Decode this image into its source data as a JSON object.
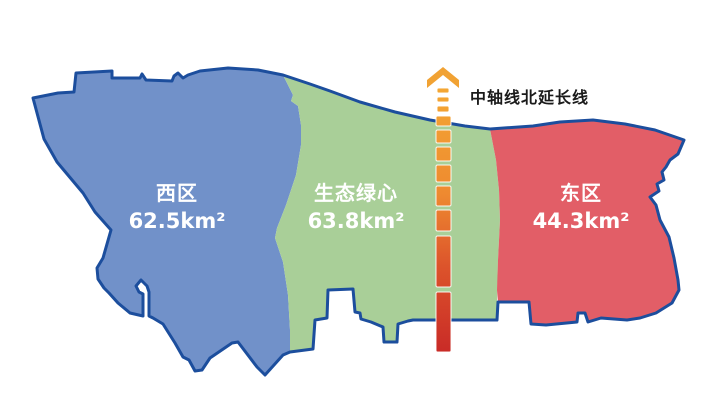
{
  "map": {
    "background_color": "#FFFFFF",
    "outline_color": "#1C4E9D",
    "regions": [
      {
        "id": "west",
        "name": "西区",
        "area": "62.5km²",
        "fill": "#7191C9",
        "label_color": "#FFFFFF"
      },
      {
        "id": "green-heart",
        "name": "生态绿心",
        "area": "63.8km²",
        "fill": "#A9CF98",
        "label_color": "#FFFFFF"
      },
      {
        "id": "east",
        "name": "东区",
        "area": "44.3km²",
        "fill": "#E25E67",
        "label_color": "#FFFFFF"
      }
    ]
  },
  "axis": {
    "label": "中轴线北延长线",
    "label_color": "#1A1A1A",
    "arrow_color": "#F1A233",
    "gradient_stops": [
      {
        "offset": "0%",
        "color": "#F4A733"
      },
      {
        "offset": "40%",
        "color": "#EE8A30"
      },
      {
        "offset": "68%",
        "color": "#DC532B"
      },
      {
        "offset": "100%",
        "color": "#C92B27"
      }
    ]
  }
}
